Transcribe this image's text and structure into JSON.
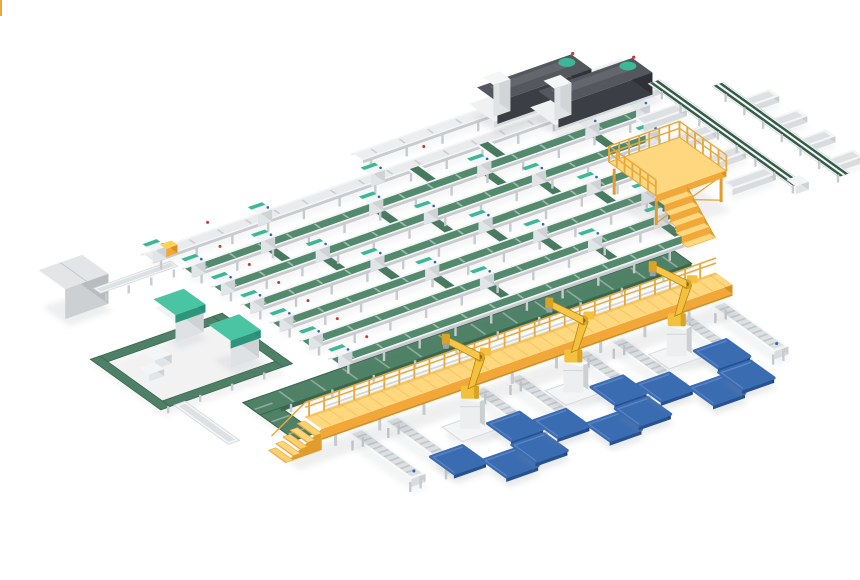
{
  "scene": {
    "name": "automated-sorting-palletizing-line-3d-render",
    "background": "#ffffff",
    "width": 860,
    "height": 580
  },
  "palette": {
    "belt_green": "#538a6d",
    "belt_green_dark": "#335c47",
    "ramp_green": "#47795f",
    "trunk_green": "#4e8166",
    "loop_green": "#4e8067",
    "frame_white": "#f3f5f6",
    "frame_mid": "#e2e5e7",
    "frame_shade": "#cfd3d5",
    "leg_gray": "#c7cbce",
    "roller_gray": "#c3c7ca",
    "inner_gray": "#dde1e3",
    "teal": "#3cb896",
    "teal_dark": "#2b967b",
    "teal_light": "#4ac4a3",
    "walk_top": "#ffd77e",
    "walk_top_edge": "#f6c55c",
    "walk_face": "#f1a838",
    "walk_face_dark": "#d88f23",
    "rail_yellow": "#e8a93c",
    "stringer": "#e09d2b",
    "robot_yellow": "#f3c13e",
    "robot_mid": "#d9a326",
    "robot_dark": "#b5850f",
    "pallet_top": "#3a6cb2",
    "pallet_light": "#5d85c5",
    "pallet_front": "#27518f",
    "pallet_right": "#1c3e7c",
    "mach_top": "#54575d",
    "mach_face": "#3b3e44",
    "mach_end": "#2e3136",
    "mach_panel": "#63666c",
    "gray_top": "#e3e5e7",
    "gray_face": "#cdd0d2",
    "gray_side": "#b9bcbf",
    "shadow": "#878c91",
    "dot_red": "#c23b2e",
    "dot_blue": "#2f63c9",
    "accent_yellow": "#ffd154"
  },
  "layout": {
    "iso": {
      "u": [
        0.94,
        -0.33
      ],
      "v": [
        0.78,
        0.56
      ],
      "origin": [
        148,
        260
      ]
    },
    "spine": {
      "y": 0,
      "x0": 0,
      "x1": 535,
      "w": 12
    },
    "machine_line": {
      "y": -32,
      "x0": 250,
      "x1": 535,
      "w": 11
    },
    "lanes": [
      {
        "y": 34,
        "x0": 15,
        "x1": 502
      },
      {
        "y": 68,
        "x0": 18,
        "x1": 484
      },
      {
        "y": 102,
        "x0": 21,
        "x1": 466
      },
      {
        "y": 136,
        "x0": 24,
        "x1": 448
      },
      {
        "y": 170,
        "x0": 27,
        "x1": 430
      },
      {
        "y": 204,
        "x0": 30,
        "x1": 412
      }
    ],
    "ramps": [
      {
        "from": 0,
        "xs": [
          278,
          352
        ]
      },
      {
        "from": 1,
        "xs": [
          95,
          210,
          325,
          440
        ]
      },
      {
        "from": 2,
        "xs": [
          125,
          240,
          355
        ]
      },
      {
        "from": 3,
        "xs": [
          155,
          270,
          385
        ]
      },
      {
        "from": 4,
        "xs": [
          185,
          300,
          415
        ]
      },
      {
        "from": 5,
        "xs": [
          215,
          330,
          400
        ]
      }
    ],
    "trunk": {
      "leg1": {
        "x0": -52,
        "x1": 385,
        "y": 222,
        "w": 22
      },
      "leg2": {
        "x": -63,
        "y0": 211,
        "y1": 278,
        "w": 22
      }
    },
    "loop": {
      "x0": -140,
      "x1": -10,
      "y0": 100,
      "y1": 180,
      "w": 10
    },
    "feeder": {
      "y": 19,
      "x0": -70,
      "x1": 12,
      "w": 9
    },
    "v_line": {
      "x": -120,
      "y0": 185,
      "y1": 255,
      "w": 12
    },
    "rails": [
      {
        "y": 250,
        "x0": -20,
        "x1": 372
      },
      {
        "y": 262,
        "x0": -20,
        "x1": 372
      }
    ],
    "comb": {
      "lines": [
        {
          "x": 535,
          "y0": 4,
          "y1": 188
        },
        {
          "x": 578,
          "y0": 34,
          "y1": 196
        }
      ],
      "traysA": {
        "x0": 482,
        "x1": 528,
        "ys": [
          48,
          86,
          124,
          162
        ]
      },
      "traysB": {
        "x0": 580,
        "x1": 608,
        "ys": [
          70,
          106,
          142,
          178
        ]
      }
    },
    "machines_dark": [
      [
        385,
        -42
      ],
      [
        425,
        -12
      ]
    ],
    "machines_teal": [
      [
        -62,
        84
      ],
      [
        -48,
        138
      ]
    ],
    "gray_machine": [
      -118,
      2
    ],
    "platform": {
      "x": 395,
      "y": 115,
      "dx": 75,
      "dy": 60,
      "lift": 26,
      "thick": 6
    },
    "walkway": {
      "x0": -65,
      "x1": 372,
      "y": 279,
      "w": 22,
      "lift": 12,
      "thick": 9
    },
    "tables": {
      "xs": [
        -30,
        8,
        100,
        138,
        210,
        248,
        318,
        356
      ],
      "y0": 301,
      "len": 82,
      "w": 15
    },
    "robots": {
      "xs": [
        62,
        172,
        282
      ],
      "y": 338
    },
    "pallets": {
      "size": [
        34,
        30
      ],
      "offsets": [
        [
          30,
          22
        ],
        [
          -44,
          38
        ],
        [
          -10,
          64
        ],
        [
          26,
          58
        ]
      ]
    },
    "accents": {
      "spine_yellow_box": {
        "x": 16,
        "y": -4
      }
    }
  }
}
